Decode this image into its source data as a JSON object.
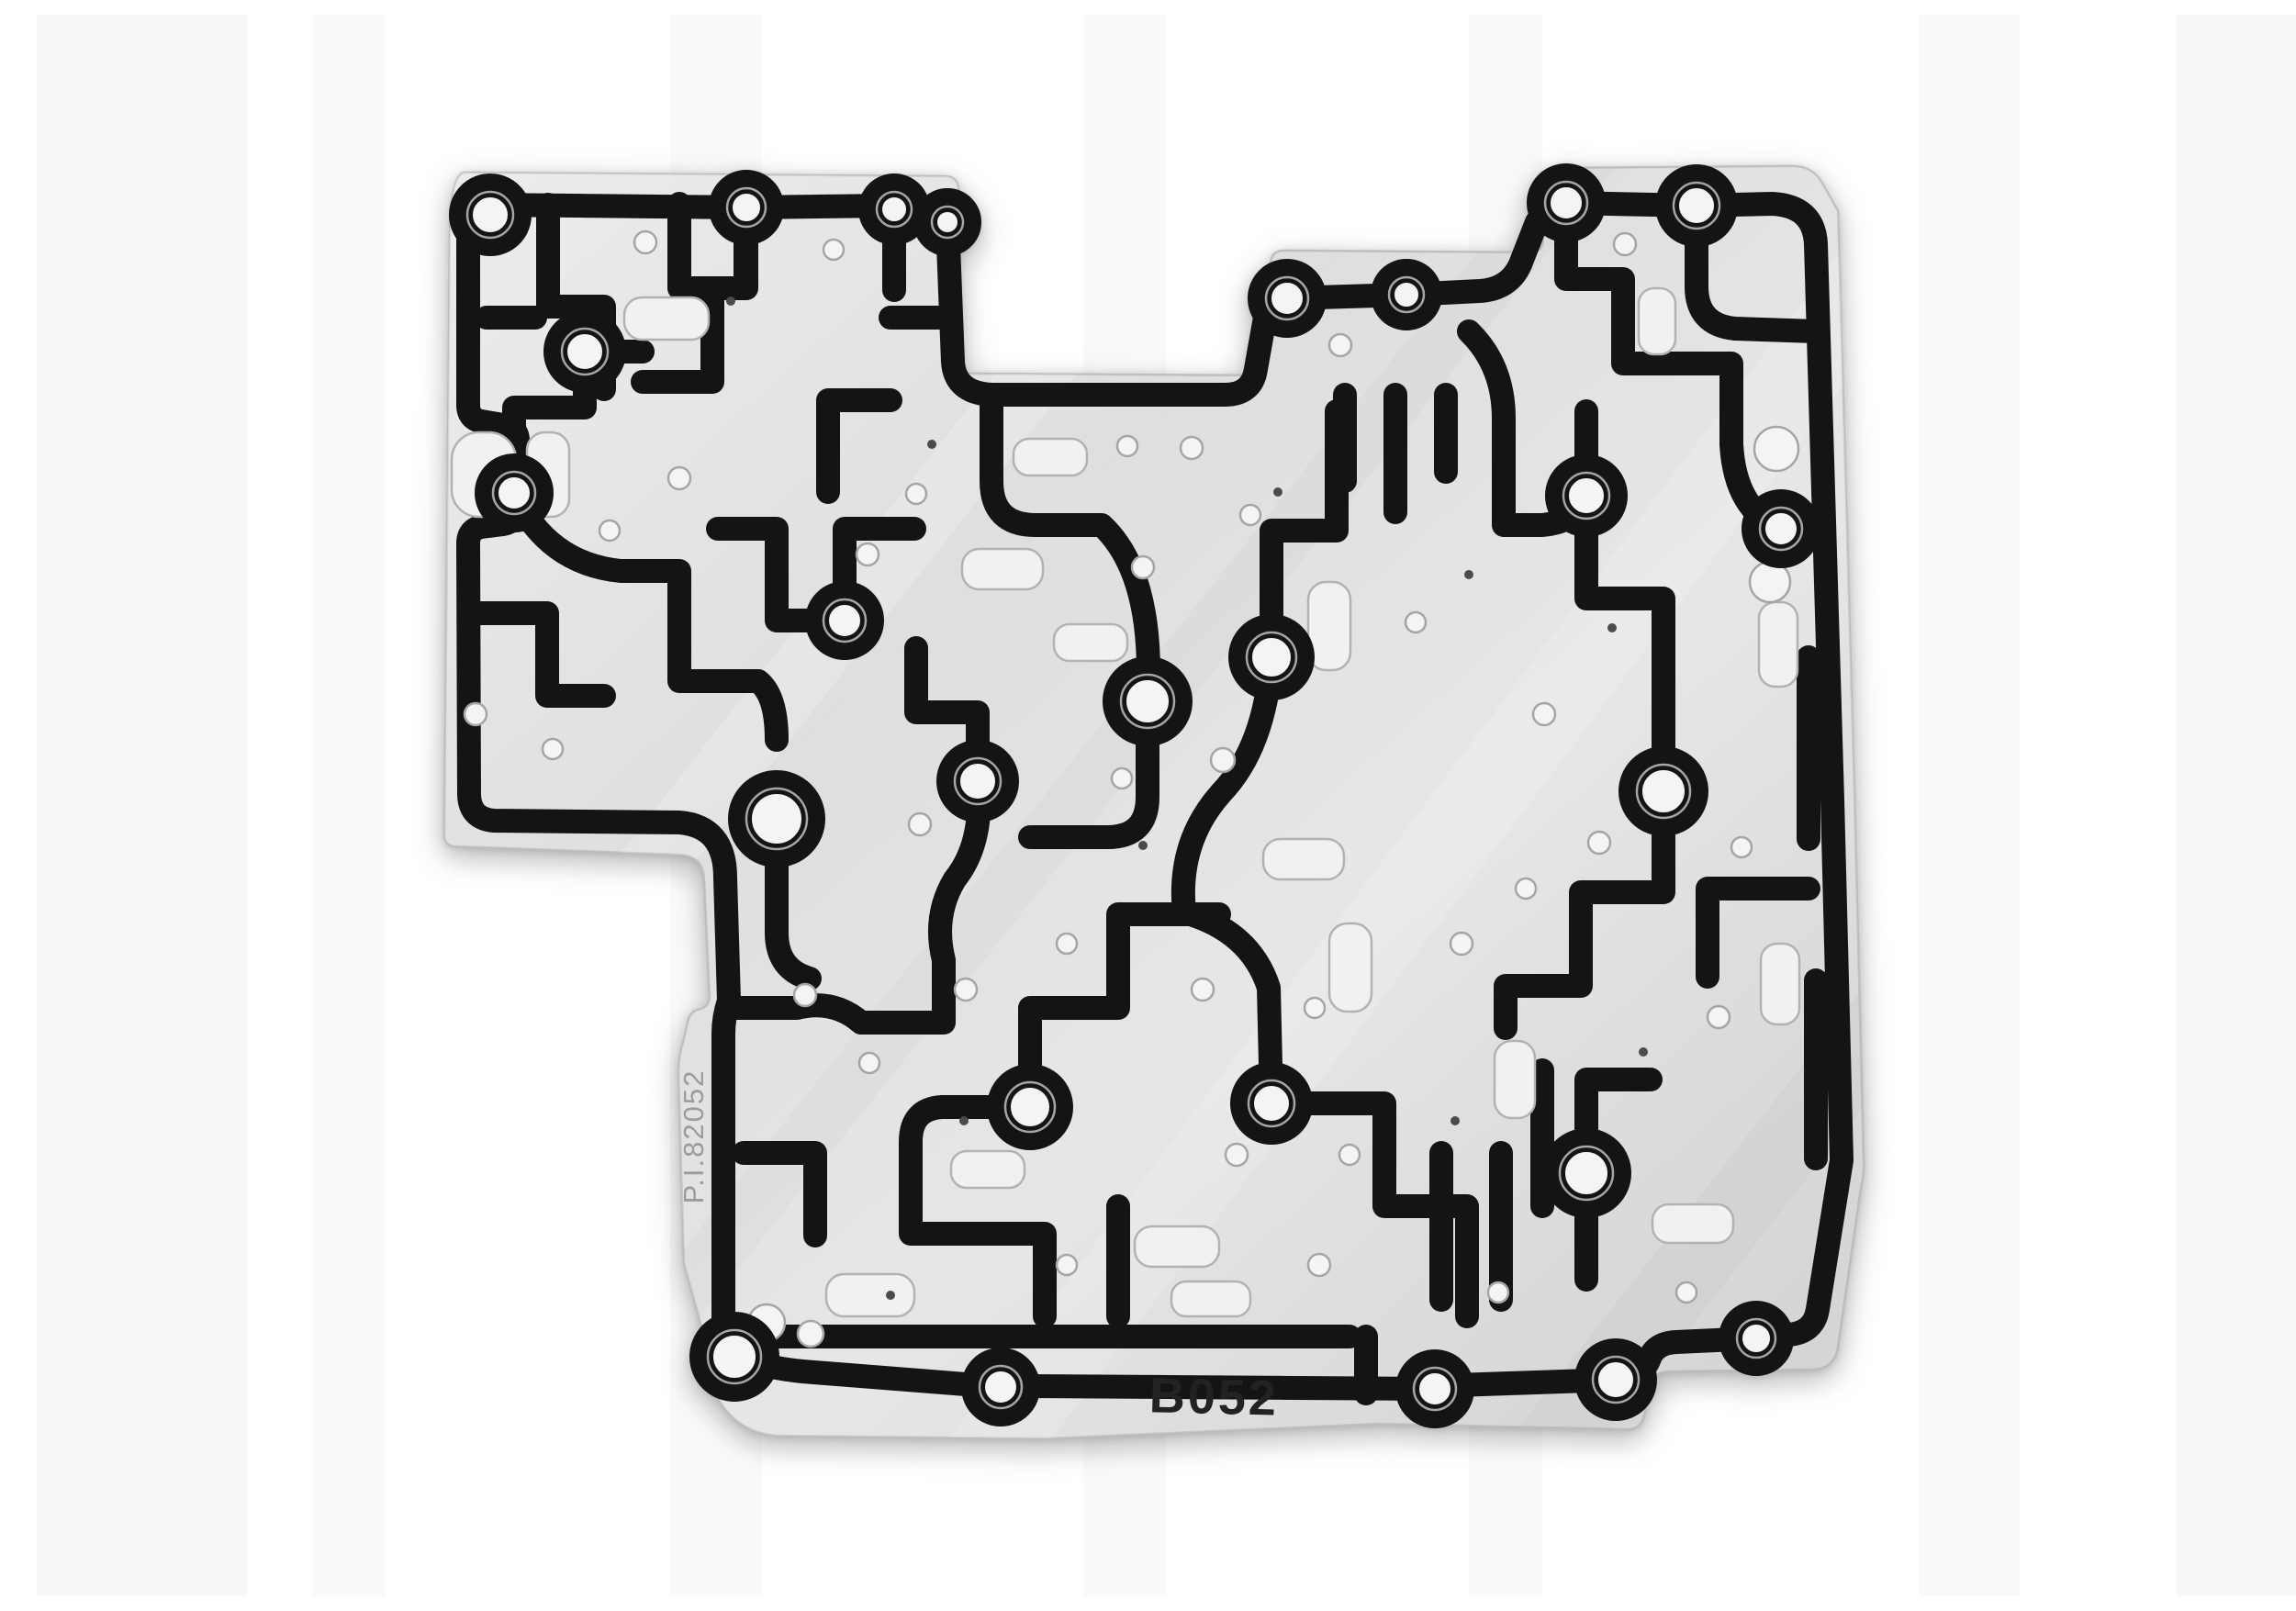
{
  "scene": {
    "description": "Product photograph of an automatic transmission valve body separator plate with bonded black rubber gasket channels, on a white background",
    "background_color": "#ffffff"
  },
  "plate": {
    "part_number": "B052",
    "side_label": "P.I.82052",
    "colors": {
      "metal": "#dcdbd9",
      "metal_edge": "#bcbbb9",
      "gasket": "#141413",
      "hole_fill": "#f4f4f2",
      "hole_rim": "#a6a5a3",
      "slot_fill": "#f1f1ef",
      "slot_rim": "#b3b2b0",
      "pinhole": "#4c4b49",
      "stamped_text": "#222220",
      "etched_text": "#9c9b99"
    },
    "bolt_holes": [
      [
        494,
        218,
        32
      ],
      [
        773,
        210,
        28
      ],
      [
        934,
        212,
        26
      ],
      [
        992,
        226,
        24
      ],
      [
        1666,
        205,
        30
      ],
      [
        1808,
        208,
        32
      ],
      [
        1362,
        309,
        30
      ],
      [
        1492,
        305,
        26
      ],
      [
        597,
        367,
        32
      ],
      [
        520,
        521,
        30
      ],
      [
        880,
        660,
        30
      ],
      [
        1210,
        748,
        36
      ],
      [
        1025,
        835,
        32
      ],
      [
        806,
        876,
        40
      ],
      [
        1345,
        700,
        34
      ],
      [
        1688,
        524,
        32
      ],
      [
        1900,
        560,
        30
      ],
      [
        1772,
        846,
        36
      ],
      [
        1082,
        1190,
        34
      ],
      [
        1345,
        1186,
        32
      ],
      [
        1688,
        1262,
        36
      ],
      [
        760,
        1462,
        36
      ],
      [
        1050,
        1495,
        30
      ],
      [
        1523,
        1497,
        30
      ],
      [
        1720,
        1487,
        32
      ],
      [
        1873,
        1442,
        28
      ]
    ],
    "small_holes": [
      [
        663,
        248,
        12
      ],
      [
        868,
        256,
        11
      ],
      [
        700,
        505,
        12
      ],
      [
        624,
        562,
        11
      ],
      [
        478,
        762,
        12
      ],
      [
        562,
        800,
        11
      ],
      [
        905,
        588,
        12
      ],
      [
        958,
        522,
        11
      ],
      [
        1420,
        360,
        12
      ],
      [
        1188,
        470,
        11
      ],
      [
        1258,
        472,
        12
      ],
      [
        1322,
        545,
        11
      ],
      [
        1205,
        602,
        12
      ],
      [
        1292,
        812,
        13
      ],
      [
        1182,
        832,
        11
      ],
      [
        962,
        882,
        12
      ],
      [
        1012,
        1062,
        12
      ],
      [
        1122,
        1012,
        11
      ],
      [
        1270,
        1062,
        12
      ],
      [
        1392,
        1082,
        11
      ],
      [
        1552,
        1012,
        12
      ],
      [
        1622,
        952,
        11
      ],
      [
        1702,
        902,
        12
      ],
      [
        1857,
        907,
        11
      ],
      [
        1832,
        1092,
        12
      ],
      [
        1430,
        1242,
        11
      ],
      [
        1307,
        1242,
        12
      ],
      [
        907,
        1142,
        11
      ],
      [
        837,
        1068,
        12
      ],
      [
        1122,
        1362,
        11
      ],
      [
        1397,
        1362,
        12
      ],
      [
        1592,
        1392,
        11
      ],
      [
        1797,
        1392,
        11
      ],
      [
        1642,
        762,
        12
      ],
      [
        1502,
        662,
        11
      ],
      [
        795,
        1425,
        20
      ],
      [
        843,
        1437,
        14
      ],
      [
        1895,
        473,
        24
      ],
      [
        1888,
        618,
        22
      ],
      [
        1730,
        250,
        12
      ]
    ],
    "pinholes": [
      [
        756,
        312
      ],
      [
        975,
        468
      ],
      [
        1352,
        520
      ],
      [
        1560,
        610
      ],
      [
        1716,
        668
      ],
      [
        1205,
        905
      ],
      [
        1010,
        1205
      ],
      [
        1545,
        1205
      ],
      [
        1750,
        1130
      ],
      [
        930,
        1395
      ]
    ],
    "slots": [
      [
        640,
        308,
        92,
        46
      ],
      [
        534,
        455,
        46,
        92
      ],
      [
        452,
        455,
        70,
        92
      ],
      [
        1108,
        664,
        80,
        40
      ],
      [
        1385,
        618,
        46,
        96
      ],
      [
        1008,
        582,
        88,
        44
      ],
      [
        1336,
        898,
        88,
        44
      ],
      [
        1408,
        990,
        46,
        96
      ],
      [
        860,
        1372,
        96,
        46
      ],
      [
        1196,
        1320,
        92,
        44
      ],
      [
        1236,
        1380,
        86,
        38
      ],
      [
        1876,
        640,
        42,
        92
      ],
      [
        1878,
        1012,
        42,
        88
      ],
      [
        1588,
        1118,
        44,
        84
      ],
      [
        1760,
        1296,
        88,
        42
      ],
      [
        1745,
        298,
        40,
        72
      ],
      [
        996,
        1238,
        80,
        40
      ],
      [
        1064,
        462,
        80,
        40
      ]
    ]
  }
}
